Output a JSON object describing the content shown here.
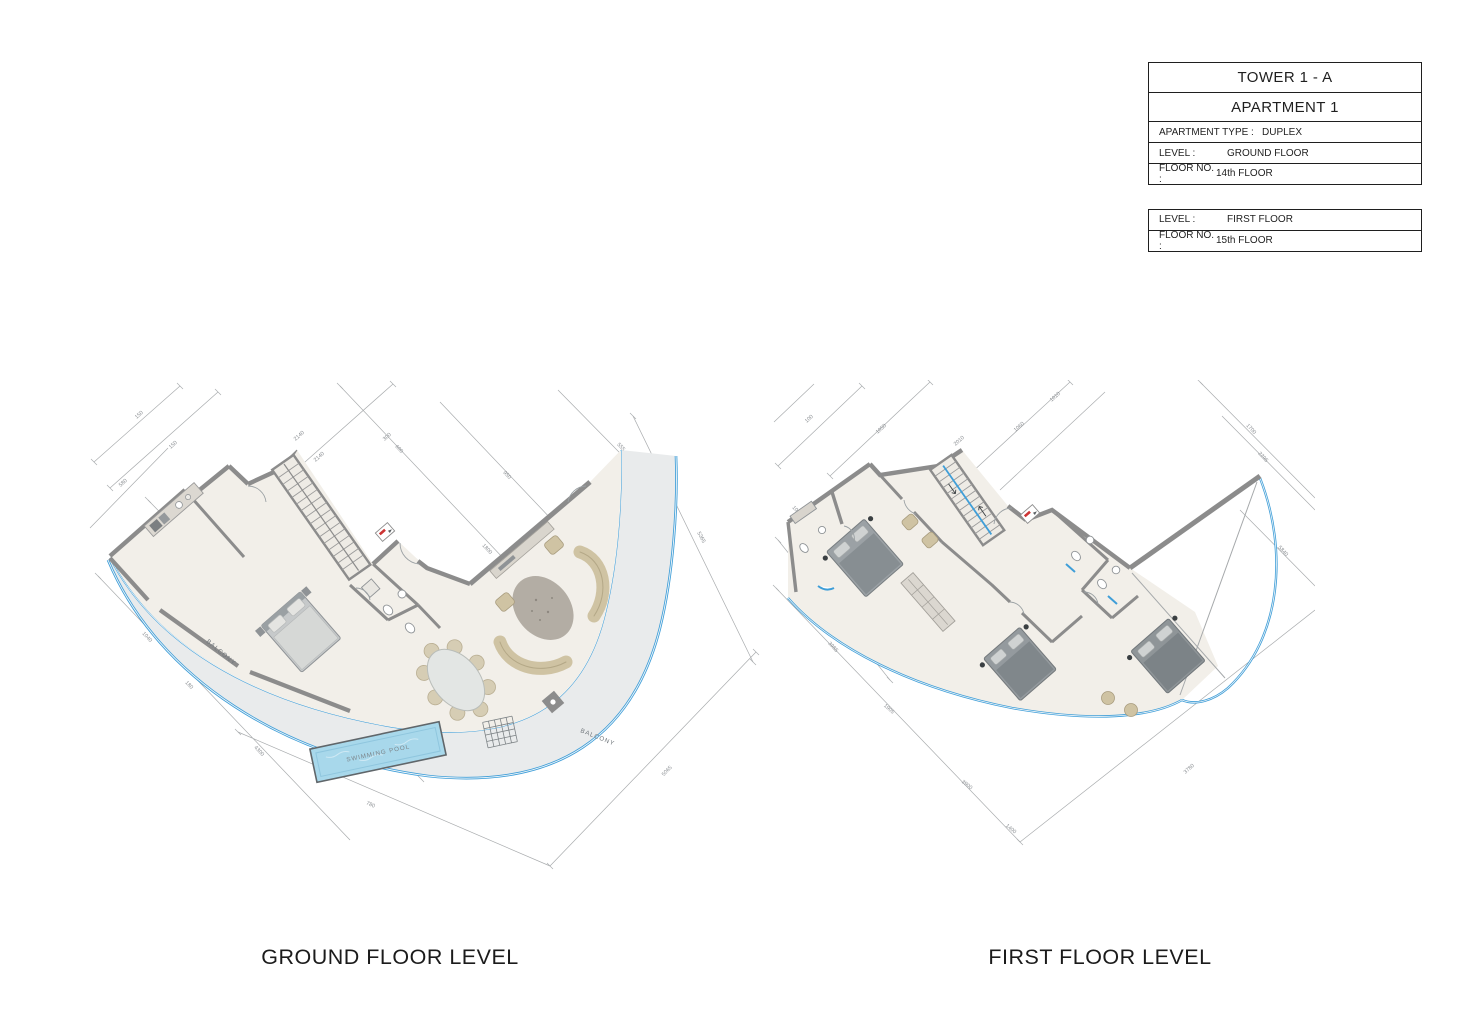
{
  "title_block": {
    "tower": "TOWER 1 - A",
    "apartment": "APARTMENT  1",
    "rows": [
      {
        "label": "APARTMENT TYPE :",
        "value": "DUPLEX"
      },
      {
        "label": "LEVEL :",
        "value": "GROUND FLOOR"
      },
      {
        "label": "FLOOR NO. :",
        "value": "14th FLOOR"
      }
    ],
    "rows2": [
      {
        "label": "LEVEL :",
        "value": "FIRST FLOOR"
      },
      {
        "label": "FLOOR NO. :",
        "value": "15th FLOOR"
      }
    ]
  },
  "plans": {
    "ground": {
      "caption": "GROUND FLOOR LEVEL",
      "labels": {
        "balcony_left": "BALCONY",
        "balcony_right": "BALCONY",
        "pool": "SWIMMING POOL"
      },
      "dims": [
        "580",
        "150",
        "150",
        "2140",
        "2140",
        "950",
        "600",
        "300",
        "1800",
        "5365",
        "555",
        "1040",
        "180",
        "4300",
        "780",
        "5065"
      ]
    },
    "first": {
      "caption": "FIRST FLOOR LEVEL",
      "dims": [
        "100",
        "1020",
        "910",
        "2010",
        "950",
        "1050",
        "1060",
        "1010",
        "3985",
        "1905",
        "3900",
        "1400",
        "3780",
        "2295",
        "5840",
        "1700"
      ]
    }
  },
  "colors": {
    "accent_blue": "#3f9ed8",
    "wall_gray": "#8c8c8c",
    "floor_cream": "#f2efe9",
    "balcony_gray": "#e9ebec",
    "pool_blue": "#a8d8eb",
    "furniture_beige": "#cfc3a3"
  }
}
